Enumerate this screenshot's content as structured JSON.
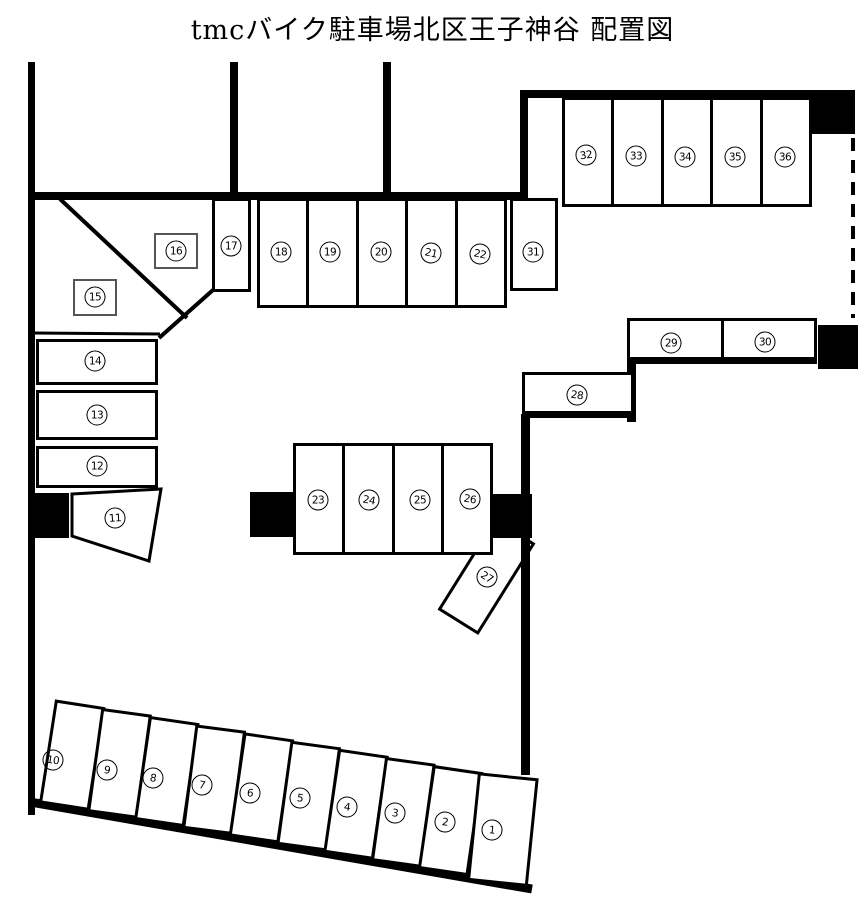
{
  "title": "tmcバイク駐車場北区王子神谷 配置図",
  "colors": {
    "line": "#000000",
    "background": "#ffffff"
  },
  "stalls": {
    "s1": "1",
    "s2": "2",
    "s3": "3",
    "s4": "4",
    "s5": "5",
    "s6": "6",
    "s7": "7",
    "s8": "8",
    "s9": "9",
    "s10": "10",
    "s11": "11",
    "s12": "12",
    "s13": "13",
    "s14": "14",
    "s15": "15",
    "s16": "16",
    "s17": "17",
    "s18": "18",
    "s19": "19",
    "s20": "20",
    "s21": "21",
    "s22": "22",
    "s23": "23",
    "s24": "24",
    "s25": "25",
    "s26": "26",
    "s27": "27",
    "s28": "28",
    "s29": "29",
    "s30": "30",
    "s31": "31",
    "s32": "32",
    "s33": "33",
    "s34": "34",
    "s35": "35",
    "s36": "36"
  }
}
